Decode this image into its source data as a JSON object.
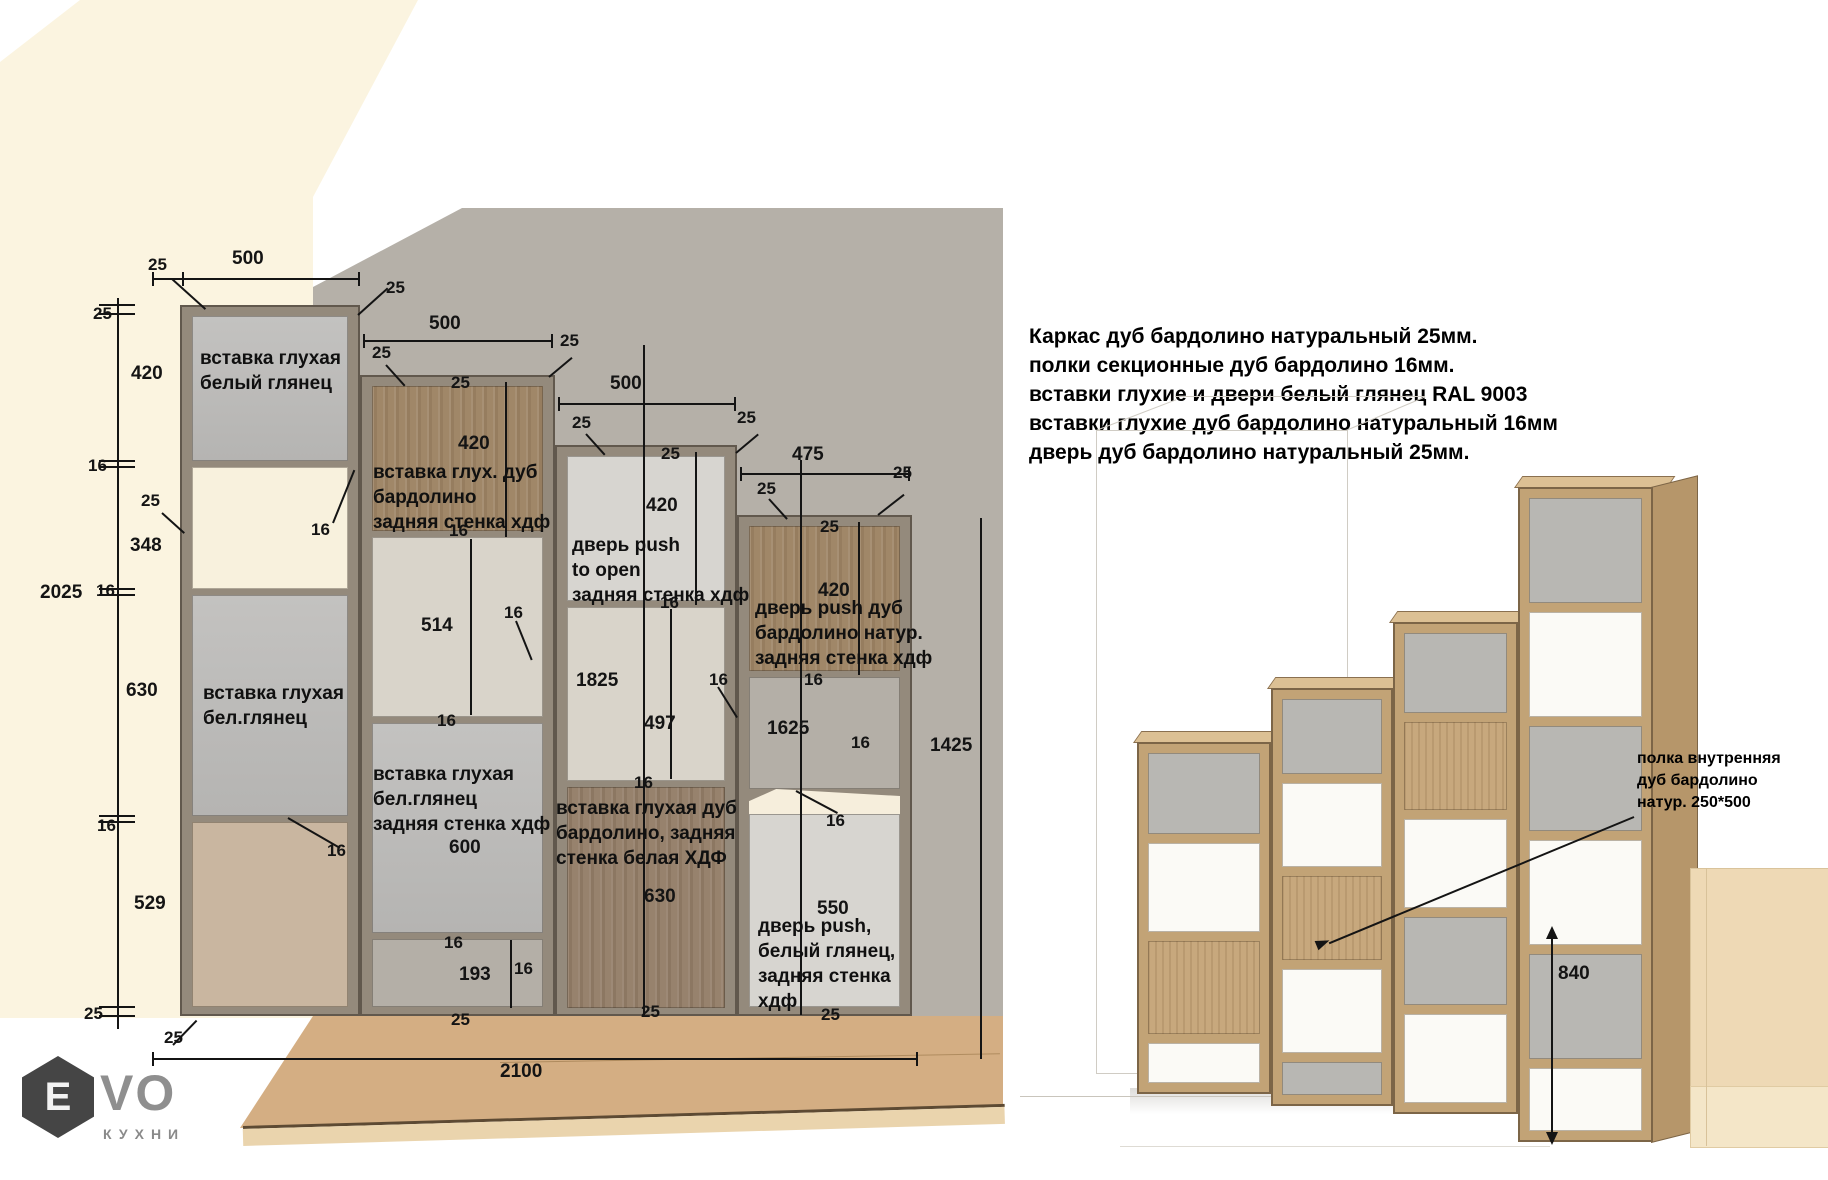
{
  "specs": {
    "lines": [
      "Каркас дуб бардолино натуральный 25мм.",
      "полки секционные дуб бардолино 16мм.",
      "вставки глухие и двери белый глянец RAL 9003",
      "вставки глухие дуб бардолино натуральный 16мм",
      "дверь дуб бардолино натуральный 25мм."
    ]
  },
  "elevation": {
    "dims": [
      "25",
      "500",
      "25",
      "420",
      "25",
      "500",
      "25",
      "25",
      "25",
      "420",
      "16",
      "25",
      "348",
      "16",
      "2025",
      "16",
      "630",
      "500",
      "25",
      "25",
      "25",
      "420",
      "475",
      "25",
      "25",
      "25",
      "420",
      "16",
      "514",
      "16",
      "16",
      "1825",
      "16",
      "497",
      "1625",
      "16",
      "16",
      "1425",
      "16",
      "16",
      "16",
      "16",
      "16",
      "529",
      "600",
      "630",
      "550",
      "16",
      "193",
      "16",
      "25",
      "25",
      "25",
      "25",
      "25",
      "2100"
    ],
    "panels": {
      "p1": "вставка глухая\nбелый глянец",
      "p2": "вставка глухая\nбел.глянец",
      "p3": "вставка глух. дуб\nбардолино\nзадняя стенка хдф",
      "p4": "вставка глухая\nбел.глянец\nзадняя стенка хдф",
      "p5": "дверь push\nto open\nзадняя стенка хдф",
      "p6": "вставка глухая дуб\nбардолино, задняя\nстенка белая ХДФ",
      "p7": "дверь push дуб\nбардолино натур.\nзадняя стенка хдф",
      "p8": "дверь push,\nбелый глянец,\nзадняя стенка\nхдф"
    }
  },
  "render": {
    "annotation": "полка внутренняя\nдуб бардолино\nнатур. 250*500",
    "height_dim": "840"
  },
  "logo": {
    "mark": "Е",
    "name": "VO",
    "sub": "КУХНИ"
  },
  "colors": {
    "wall": "#b5b0a8",
    "accent_wood": "#a08768",
    "floor": "#d4ae83"
  }
}
